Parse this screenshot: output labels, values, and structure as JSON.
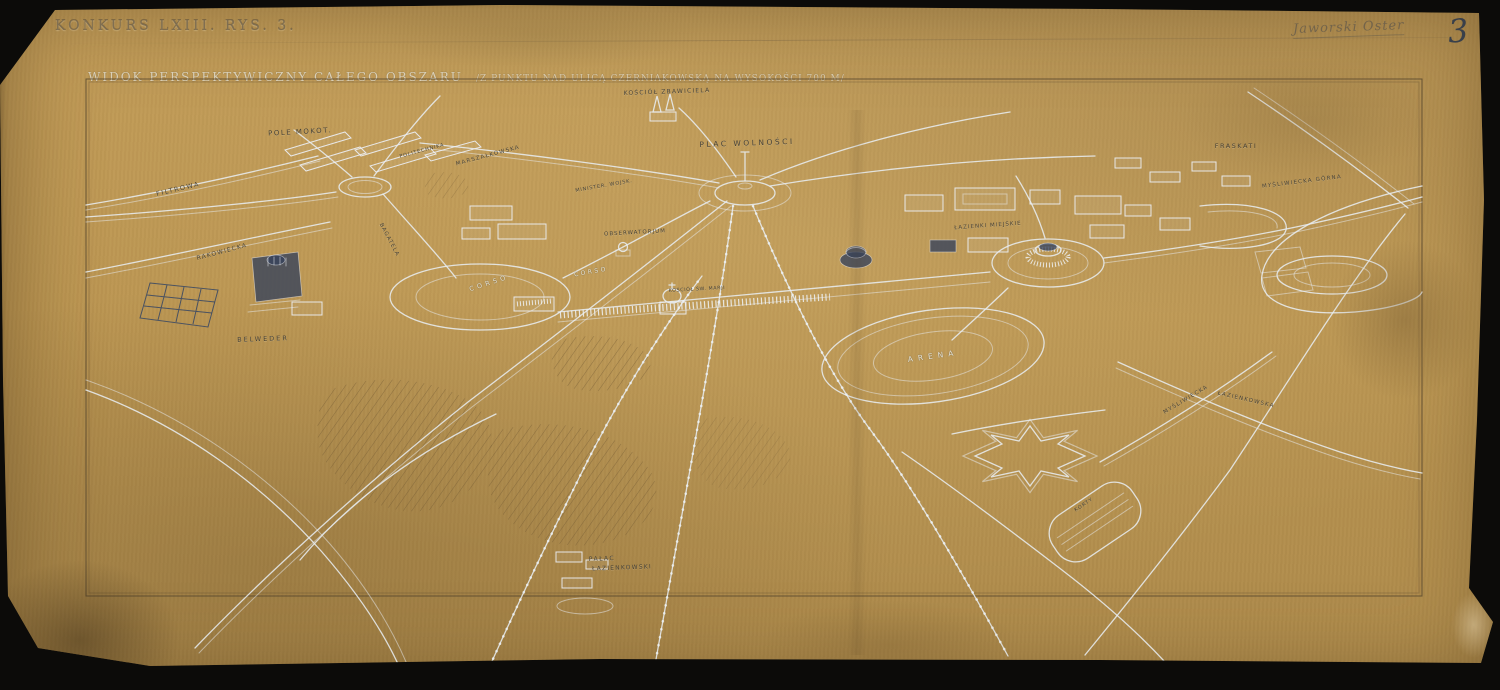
{
  "document": {
    "competition_label": "KONKURS LXIII. RYS. 3.",
    "handwritten_note": "Jaworski Oster",
    "sheet_number": "3",
    "map_title": "WIDOK PERSPEKTYWICZNY CAŁEGO OBSZARU",
    "map_title_note": "/Z PUNKTU NAD ULICĄ CZERNIAKOWSKĄ NA WYSOKOŚCI 700 M/"
  },
  "palette": {
    "backdrop": "#0c0b09",
    "paper": "#bb9551",
    "paper_light": "#c29c58",
    "paper_dark": "#ad8a4b",
    "ink_light": "#e9eef4",
    "ink_dark": "#3d4a63",
    "pencil": "#6e5a38",
    "label_dark": "#3e3a30",
    "label_light": "#f0eee2"
  },
  "map_labels": [
    {
      "text": "POLE MOKOT.",
      "x": 300,
      "y": 132,
      "rot": -3,
      "size": 7,
      "tone": "dark",
      "ls": 1.5
    },
    {
      "text": "FILTROWA",
      "x": 178,
      "y": 189,
      "rot": -13,
      "size": 6.5,
      "tone": "dark",
      "ls": 1.5
    },
    {
      "text": "KOŚCIÓŁ ZBAWICIELA",
      "x": 667,
      "y": 92,
      "rot": -2,
      "size": 6,
      "tone": "dark",
      "ls": 1.2
    },
    {
      "text": "PLAC WOLNOŚCI",
      "x": 747,
      "y": 143,
      "rot": -2,
      "size": 7.5,
      "tone": "dark",
      "ls": 2.5
    },
    {
      "text": "FRASKATI",
      "x": 1236,
      "y": 146,
      "rot": 0,
      "size": 6.5,
      "tone": "dark",
      "ls": 1.5
    },
    {
      "text": "MYŚLIWIECKA GÓRNA",
      "x": 1302,
      "y": 182,
      "rot": -7,
      "size": 5.5,
      "tone": "dark",
      "ls": 1.2
    },
    {
      "text": "ŁAZIENKI MIEJSKIE",
      "x": 988,
      "y": 226,
      "rot": -4,
      "size": 5.5,
      "tone": "dark",
      "ls": 1
    },
    {
      "text": "OBSERWATORJUM",
      "x": 635,
      "y": 233,
      "rot": -3,
      "size": 5.5,
      "tone": "dark",
      "ls": 1
    },
    {
      "text": "MINISTER. WOJSK.",
      "x": 604,
      "y": 186,
      "rot": -10,
      "size": 5,
      "tone": "dark",
      "ls": 0.8
    },
    {
      "text": "MARSZAŁKOWSKA",
      "x": 488,
      "y": 156,
      "rot": -15,
      "size": 5.5,
      "tone": "dark",
      "ls": 1.2
    },
    {
      "text": "POLITECHNIKA",
      "x": 422,
      "y": 151,
      "rot": -15,
      "size": 5,
      "tone": "dark",
      "ls": 0.8
    },
    {
      "text": "RAKOWIECKA",
      "x": 222,
      "y": 252,
      "rot": -15,
      "size": 6,
      "tone": "dark",
      "ls": 1.2
    },
    {
      "text": "BAGATELA",
      "x": 389,
      "y": 240,
      "rot": 62,
      "size": 5.5,
      "tone": "dark",
      "ls": 1
    },
    {
      "text": "CORSO",
      "x": 489,
      "y": 283,
      "rot": -18,
      "size": 6.5,
      "tone": "light",
      "ls": 3.5
    },
    {
      "text": "CORSO",
      "x": 591,
      "y": 272,
      "rot": -10,
      "size": 6,
      "tone": "light",
      "ls": 2.5
    },
    {
      "text": "KOŚCIÓŁ ŚW. MARJI",
      "x": 697,
      "y": 290,
      "rot": -3,
      "size": 4.8,
      "tone": "dark",
      "ls": 0.6
    },
    {
      "text": "BELWEDER",
      "x": 263,
      "y": 339,
      "rot": -2,
      "size": 6.5,
      "tone": "dark",
      "ls": 2
    },
    {
      "text": "ARENA",
      "x": 933,
      "y": 356,
      "rot": -8,
      "size": 7.5,
      "tone": "light",
      "ls": 5
    },
    {
      "text": "MYŚLIWIECKA",
      "x": 1186,
      "y": 400,
      "rot": -31,
      "size": 5.5,
      "tone": "dark",
      "ls": 1.2
    },
    {
      "text": "ŁAZIENKOWSKA",
      "x": 1246,
      "y": 400,
      "rot": 13,
      "size": 5.5,
      "tone": "dark",
      "ls": 1.2
    },
    {
      "text": "KORTY",
      "x": 1084,
      "y": 505,
      "rot": -34,
      "size": 5,
      "tone": "dark",
      "ls": 1
    },
    {
      "text": "PAŁAC",
      "x": 602,
      "y": 559,
      "rot": -2,
      "size": 6,
      "tone": "dark",
      "ls": 1.5
    },
    {
      "text": "ŁAZIENKOWSKI",
      "x": 622,
      "y": 568,
      "rot": -2,
      "size": 6,
      "tone": "dark",
      "ls": 1.2
    }
  ]
}
